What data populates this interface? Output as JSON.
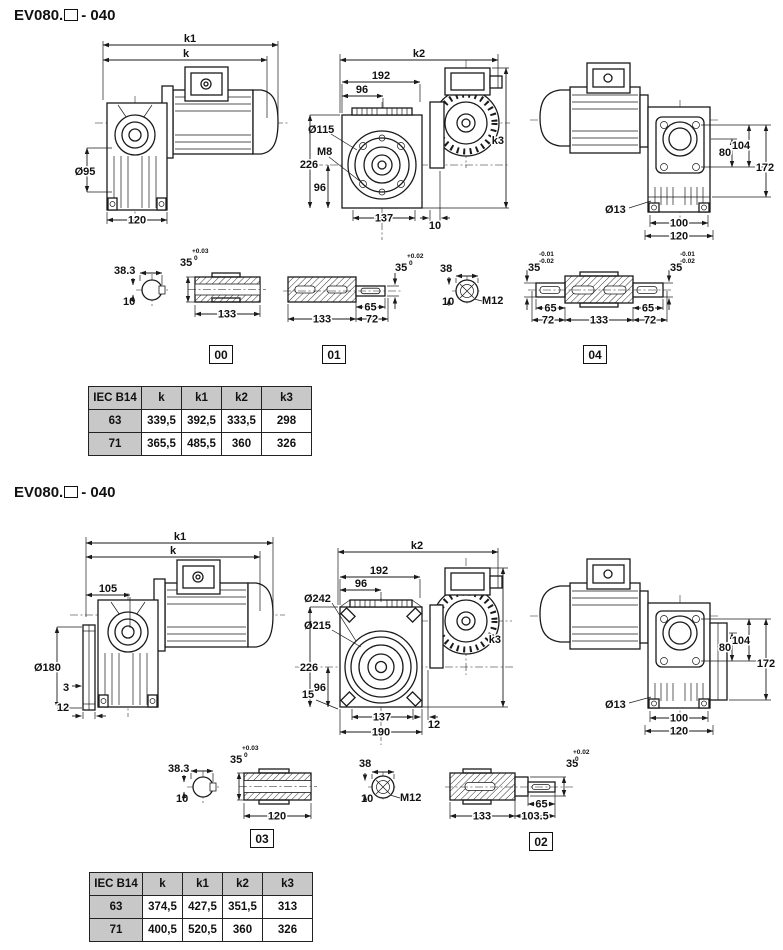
{
  "colors": {
    "line": "#1a1a1a",
    "table_header_bg": "#c8c8c8"
  },
  "s1": {
    "title": {
      "prefix": "EV080.",
      "suffix": "- 040"
    },
    "side_view": {
      "k1": "k1",
      "k": "k",
      "dia_output": "Ø95",
      "base_width": "120"
    },
    "front_view": {
      "k2": "k2",
      "k3": "k3",
      "w192": "192",
      "w96": "96",
      "dia_flange": "Ø115",
      "bolt": "M8",
      "h226": "226",
      "h96": "96",
      "w137": "137",
      "w10": "10"
    },
    "end_view": {
      "h104": "104",
      "h80": "80",
      "h172": "172",
      "dia_hole": "Ø13",
      "w100": "100",
      "w120": "120"
    },
    "shaft_00": {
      "tag": "00",
      "across": "38.3",
      "key_w": "10",
      "bore": "35",
      "tol_up": "+0.03",
      "tol_dn": "0",
      "len": "133"
    },
    "shaft_01": {
      "tag": "01",
      "len": "133",
      "l65": "65",
      "l72": "72",
      "dia": "35",
      "tol_up": "+0.02",
      "tol_dn": "0"
    },
    "key_view": {
      "across": "38",
      "key_w": "10",
      "thread": "M12"
    },
    "shaft_04": {
      "tag": "04",
      "dia_l": "35",
      "tol_l1": "-0.01",
      "tol_l2": "-0.02",
      "dia_r": "35",
      "tol_r1": "-0.01",
      "tol_r2": "-0.02",
      "l65a": "65",
      "l72a": "72",
      "len": "133",
      "l65b": "65",
      "l72b": "72"
    },
    "table": {
      "headers": [
        "IEC B14",
        "k",
        "k1",
        "k2",
        "k3"
      ],
      "rows": [
        [
          "63",
          "339,5",
          "392,5",
          "333,5",
          "298"
        ],
        [
          "71",
          "365,5",
          "485,5",
          "360",
          "326"
        ]
      ]
    }
  },
  "s2": {
    "title": {
      "prefix": "EV080.",
      "suffix": "- 040"
    },
    "side_view": {
      "k1": "k1",
      "k": "k",
      "w105": "105",
      "dia_flange": "Ø180",
      "t3": "3",
      "t12": "12"
    },
    "front_view": {
      "k2": "k2",
      "k3": "k3",
      "w192": "192",
      "w96": "96",
      "dia242": "Ø242",
      "dia215": "Ø215",
      "h226": "226",
      "h96": "96",
      "w15": "15",
      "w137": "137",
      "w12": "12",
      "w190": "190"
    },
    "end_view": {
      "h104": "104",
      "h80": "80",
      "h172": "172",
      "dia_hole": "Ø13",
      "w100": "100",
      "w120": "120"
    },
    "shaft_03": {
      "tag": "03",
      "across": "38.3",
      "key_w": "10",
      "bore": "35",
      "tol_up": "+0.03",
      "tol_dn": "0",
      "len": "120"
    },
    "key_view": {
      "across": "38",
      "key_w": "10",
      "thread": "M12"
    },
    "shaft_02": {
      "tag": "02",
      "len": "133",
      "l1035": "103.5",
      "l65": "65",
      "dia": "35",
      "tol_up": "+0.02",
      "tol_dn": "0"
    },
    "table": {
      "headers": [
        "IEC B14",
        "k",
        "k1",
        "k2",
        "k3"
      ],
      "rows": [
        [
          "63",
          "374,5",
          "427,5",
          "351,5",
          "313"
        ],
        [
          "71",
          "400,5",
          "520,5",
          "360",
          "326"
        ]
      ]
    }
  }
}
